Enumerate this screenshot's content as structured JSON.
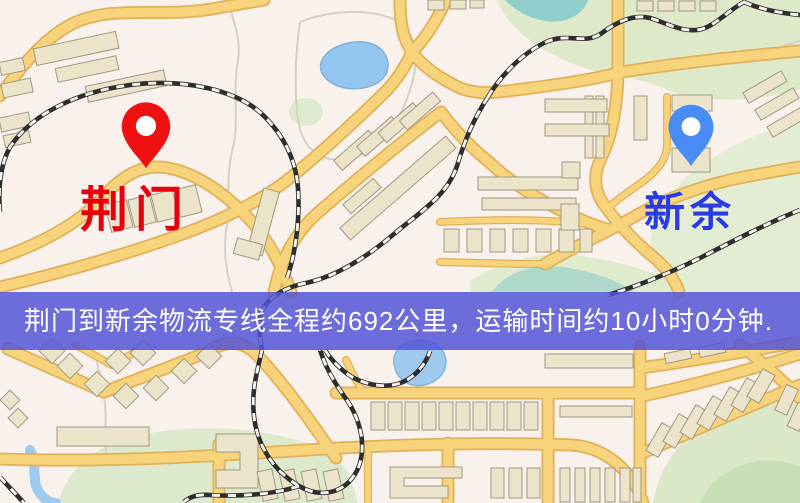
{
  "map": {
    "origin": {
      "name": "荆门",
      "label_color": "#e8000d",
      "pin_color": "#ef1111"
    },
    "destination": {
      "name": "新余",
      "label_color": "#2a3ce0",
      "pin_color": "#4a8cf5"
    }
  },
  "banner": {
    "text": "荆门到新余物流专线全程约692公里，运输时间约10小时0分钟.",
    "background_color": "#5252d8",
    "text_color": "#ffffff",
    "origin": "荆门",
    "destination": "新余",
    "service": "物流专线",
    "distance_km": "692",
    "transport_time": "10小时0分钟"
  },
  "map_palette": {
    "background": "#f8f1ec",
    "road": "#f7d47b",
    "road_casing": "#e2b058",
    "building": "#ece4ca",
    "park": "#dde9c9",
    "water": "#93c6ee",
    "railway": "#2e2e2e"
  }
}
